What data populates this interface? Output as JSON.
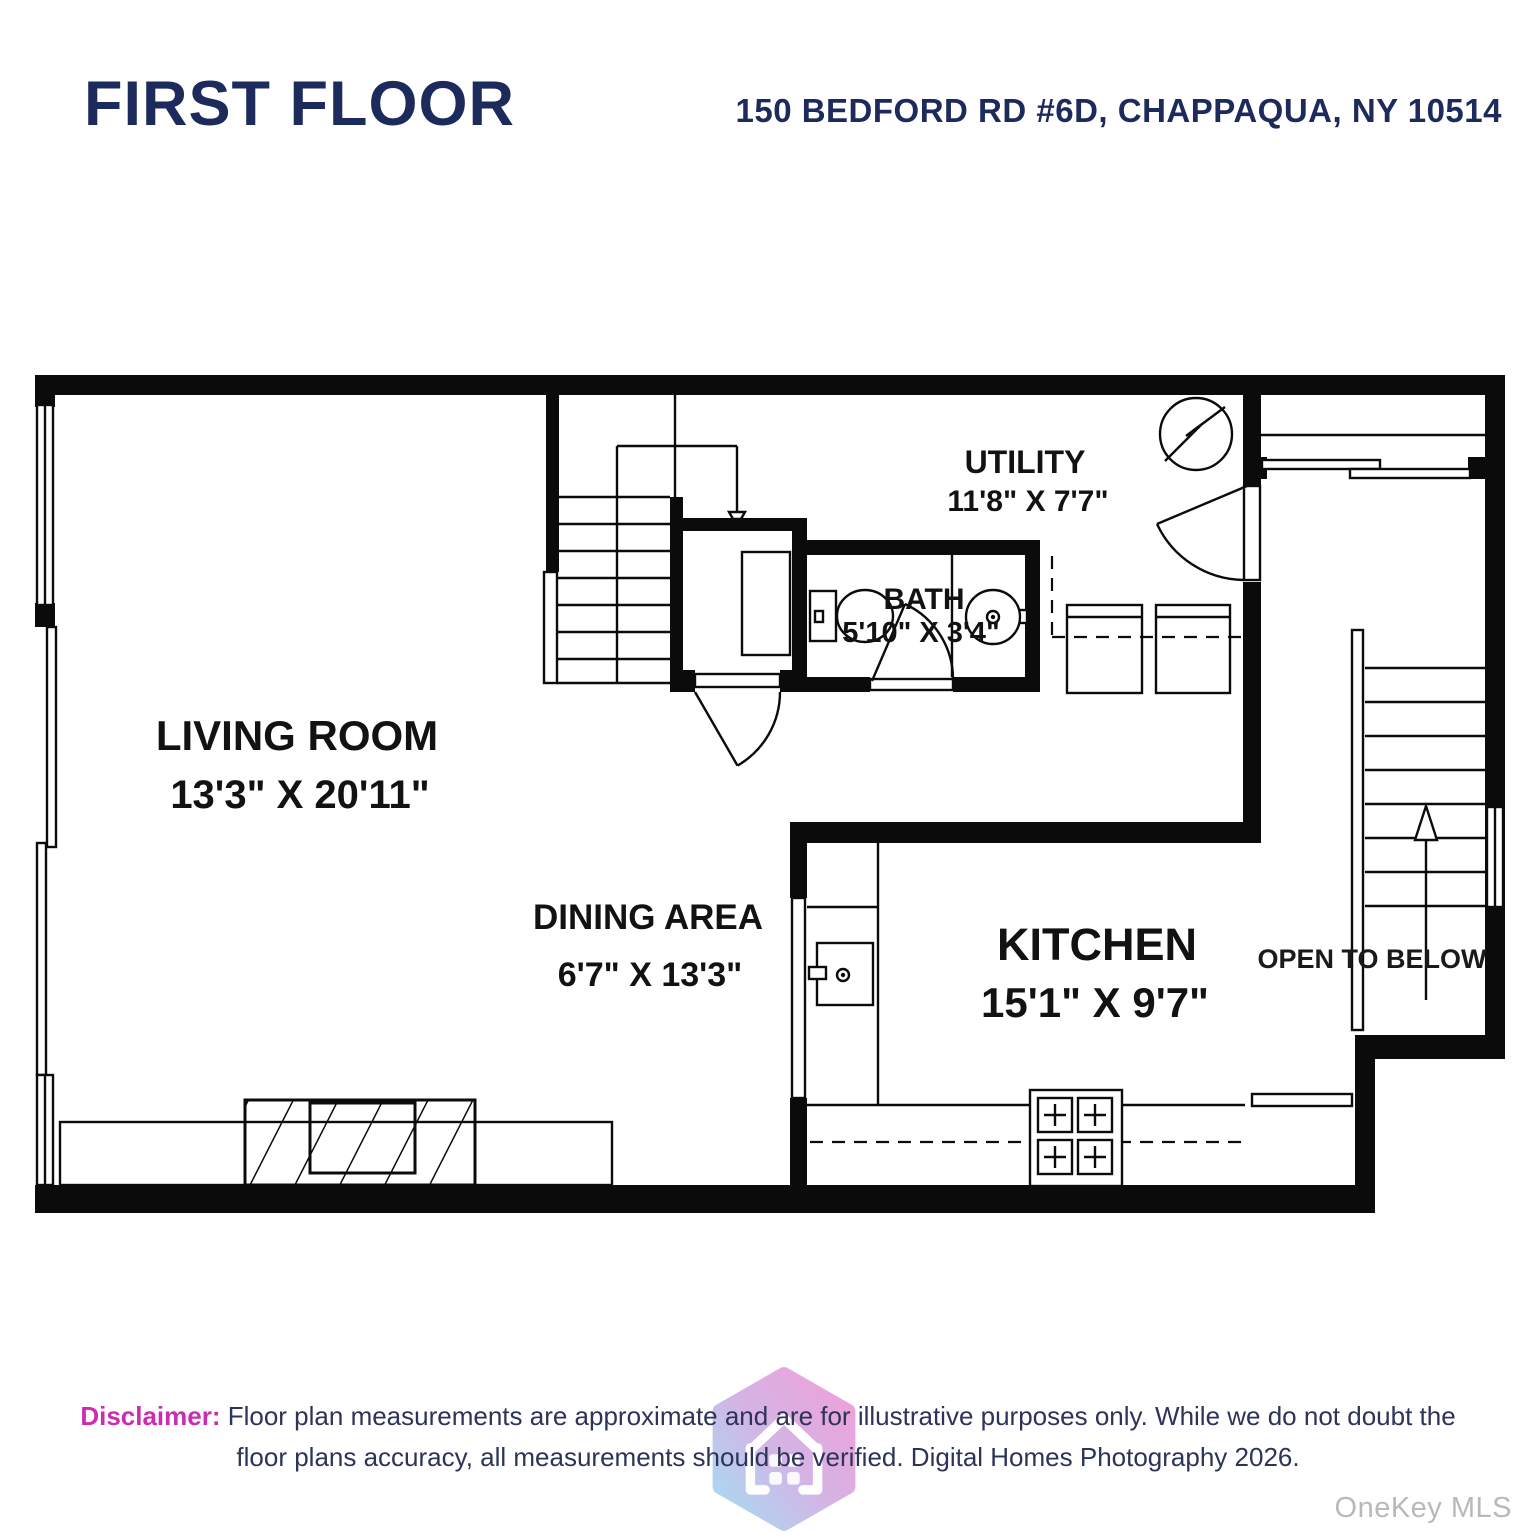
{
  "header": {
    "title": "FIRST FLOOR",
    "address": "150 BEDFORD RD #6D, CHAPPAQUA, NY 10514"
  },
  "rooms": {
    "living": {
      "name": "LIVING ROOM",
      "dims": "13'3\" X 20'11\""
    },
    "dining": {
      "name": "DINING AREA",
      "dims": "6'7\" X 13'3\""
    },
    "kitchen": {
      "name": "KITCHEN",
      "dims": "15'1\" X 9'7\""
    },
    "utility": {
      "name": "UTILITY",
      "dims": "11'8\" X 7'7\""
    },
    "bath": {
      "name": "BATH",
      "dims": "5'10\" X 3'4\""
    },
    "open_below": {
      "name": "OPEN TO BELOW"
    }
  },
  "footer": {
    "disclaimer_label": "Disclaimer:",
    "disclaimer_line1": " Floor plan measurements are approximate and are for illustrative purposes only. While we do not doubt the",
    "disclaimer_line2": "floor plans accuracy, all measurements should be verified. Digital Homes Photography 2026.",
    "brand": "OneKey MLS"
  },
  "colors": {
    "heading_navy": "#1d2a5c",
    "disclaimer_magenta": "#cb2cb0",
    "body_text": "#2e3359",
    "plan_black": "#0b0b0b",
    "brand_gray": "#b9b9b9",
    "logo_blue": "#a6dcf4",
    "logo_purple": "#d5b3e4",
    "logo_pink": "#f0a0d8"
  }
}
